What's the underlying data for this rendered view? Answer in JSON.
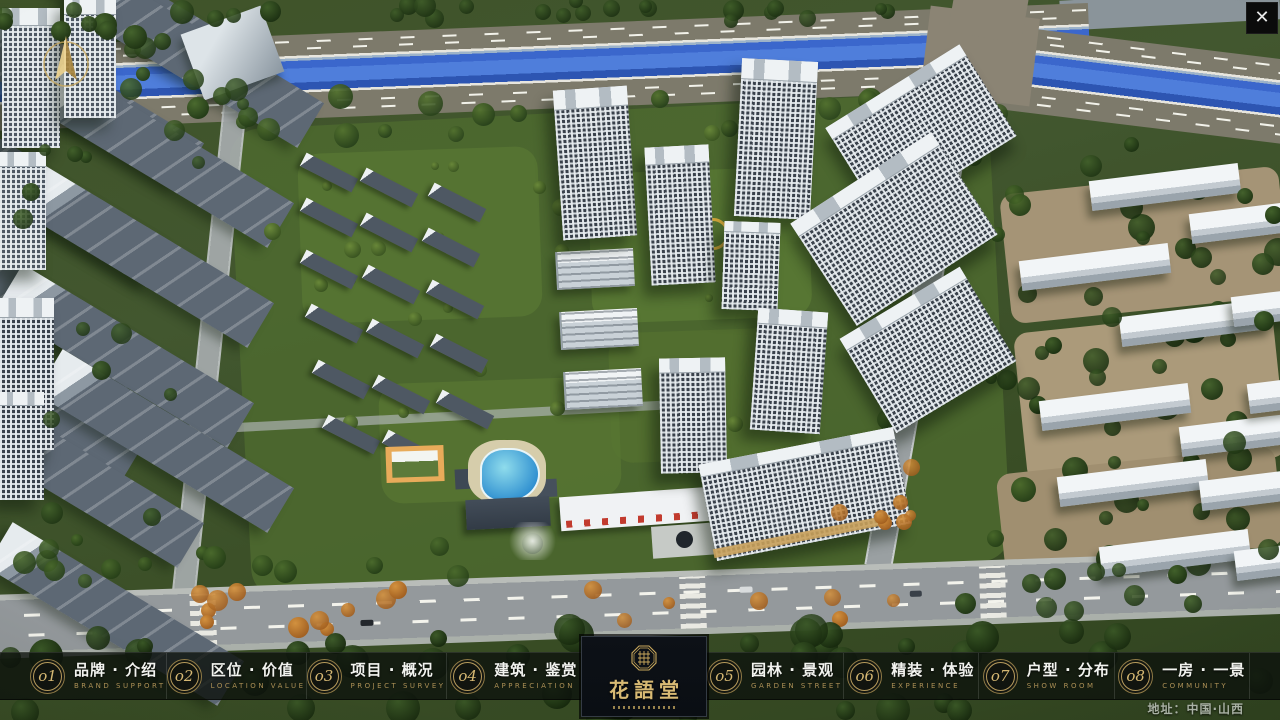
{
  "window": {
    "close_label": "✕"
  },
  "logo": {
    "title": "花語堂"
  },
  "nav": {
    "items": [
      {
        "num": "o1",
        "cn": "品牌 · 介绍",
        "en": "BRAND SUPPORT"
      },
      {
        "num": "o2",
        "cn": "区位 · 价值",
        "en": "LOCATION VALUE"
      },
      {
        "num": "o3",
        "cn": "项目 · 概况",
        "en": "PROJECT SURVEY"
      },
      {
        "num": "o4",
        "cn": "建筑 · 鉴赏",
        "en": "APPRECIATION"
      },
      {
        "num": "o5",
        "cn": "园林 · 景观",
        "en": "GARDEN STREET"
      },
      {
        "num": "o6",
        "cn": "精装 · 体验",
        "en": "EXPERIENCE"
      },
      {
        "num": "o7",
        "cn": "户型 · 分布",
        "en": "SHOW ROOM"
      },
      {
        "num": "o8",
        "cn": "一房 · 一景",
        "en": "COMMUNITY"
      }
    ]
  },
  "footer": {
    "address": "地址：中国·山西"
  },
  "colors": {
    "gold": "#c9a85c",
    "nav_bg": "#0d110d",
    "river": "#3b67cc",
    "accent_dark": "#0d1117"
  }
}
